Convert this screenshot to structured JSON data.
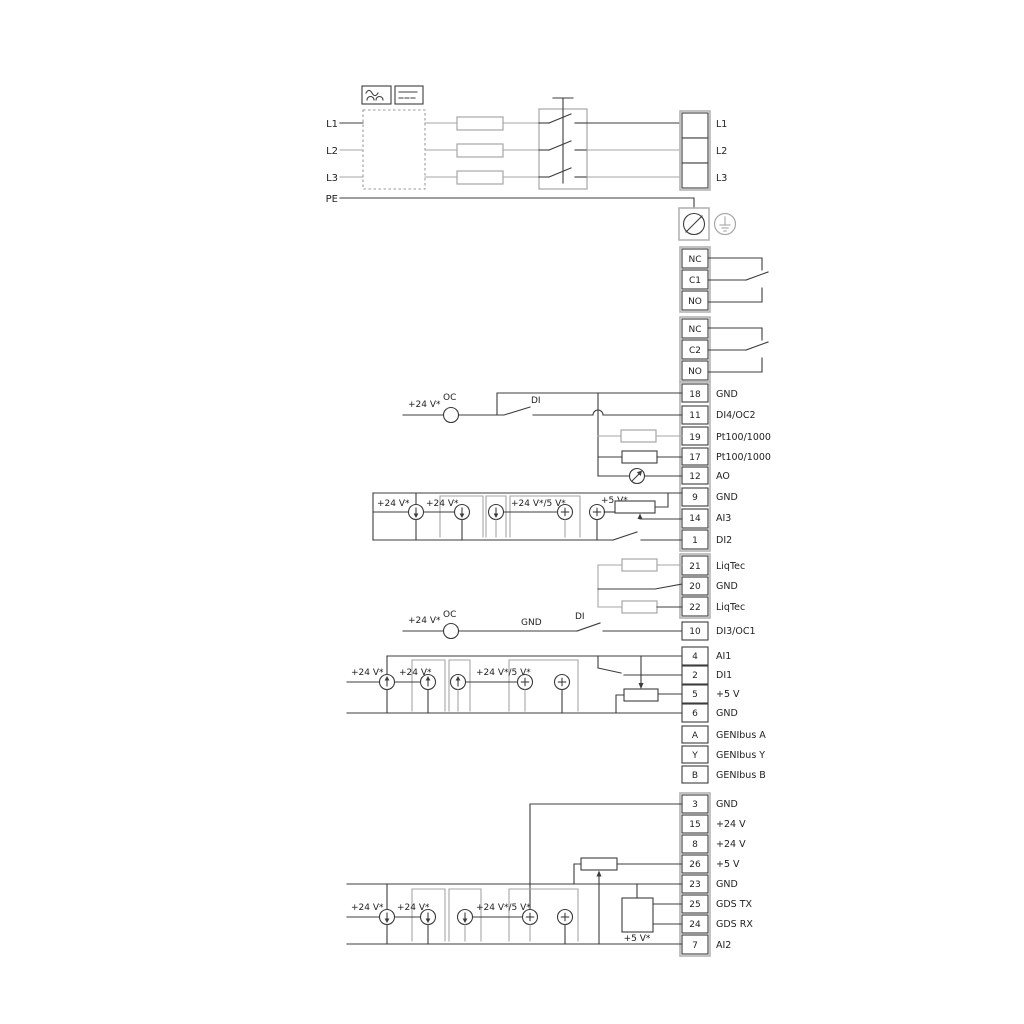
{
  "power": {
    "inputs": [
      "L1",
      "L2",
      "L3",
      "PE"
    ],
    "outputs": [
      "L1",
      "L2",
      "L3"
    ]
  },
  "relay1": [
    "NC",
    "C1",
    "NO"
  ],
  "relay2": [
    "NC",
    "C2",
    "NO"
  ],
  "io1": [
    {
      "id": "18",
      "label": "GND"
    },
    {
      "id": "11",
      "label": "DI4/OC2"
    },
    {
      "id": "19",
      "label": "Pt100/1000"
    },
    {
      "id": "17",
      "label": "Pt100/1000"
    },
    {
      "id": "12",
      "label": "AO"
    },
    {
      "id": "9",
      "label": "GND"
    },
    {
      "id": "14",
      "label": "AI3"
    },
    {
      "id": "1",
      "label": "DI2"
    }
  ],
  "liqtec": [
    {
      "id": "21",
      "label": "LiqTec"
    },
    {
      "id": "20",
      "label": "GND"
    },
    {
      "id": "22",
      "label": "LiqTec"
    }
  ],
  "io2": [
    {
      "id": "10",
      "label": "DI3/OC1"
    },
    {
      "id": "4",
      "label": "AI1"
    },
    {
      "id": "2",
      "label": "DI1"
    },
    {
      "id": "5",
      "label": "+5 V"
    },
    {
      "id": "6",
      "label": "GND"
    }
  ],
  "genibus": [
    {
      "id": "A",
      "label": "GENIbus A"
    },
    {
      "id": "Y",
      "label": "GENIbus Y"
    },
    {
      "id": "B",
      "label": "GENIbus B"
    }
  ],
  "io3": [
    {
      "id": "3",
      "label": "GND"
    },
    {
      "id": "15",
      "label": "+24 V"
    },
    {
      "id": "8",
      "label": "+24 V"
    },
    {
      "id": "26",
      "label": "+5 V"
    },
    {
      "id": "23",
      "label": "GND"
    },
    {
      "id": "25",
      "label": "GDS TX"
    },
    {
      "id": "24",
      "label": "GDS RX"
    },
    {
      "id": "7",
      "label": "AI2"
    }
  ],
  "ann": {
    "v24": "+24 V*",
    "v24_5": "+24 V*/5 V*",
    "v5": "+5 V*",
    "oc": "OC",
    "di": "DI",
    "gnd": "GND"
  },
  "colors": {
    "line": "#3c3c3c",
    "line_gray": "#a6a6a6",
    "background": "#ffffff",
    "text": "#222222"
  }
}
